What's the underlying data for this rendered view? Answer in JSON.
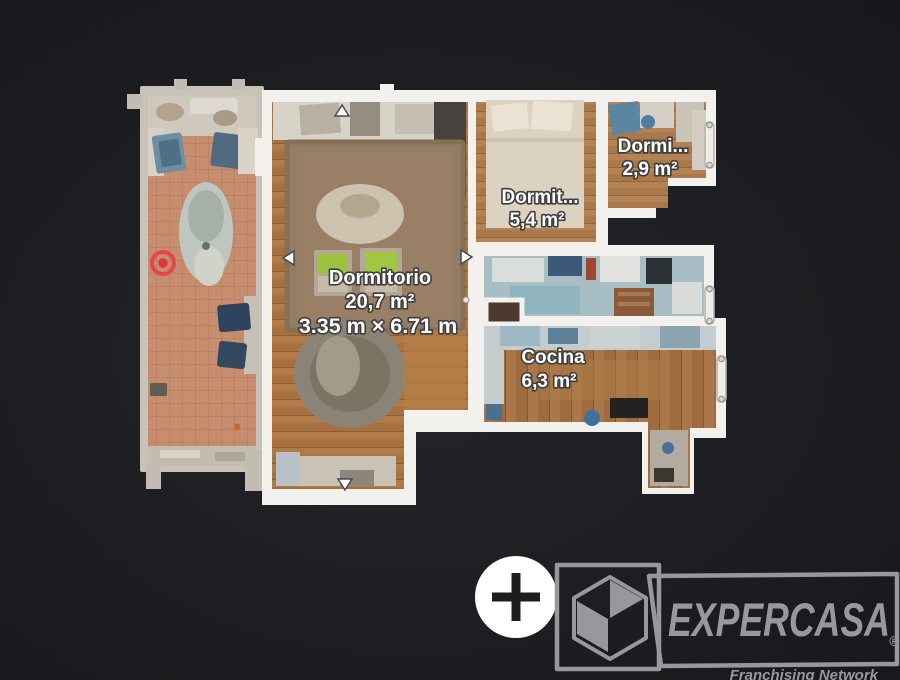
{
  "app": {
    "type": "floor-plan-viewer"
  },
  "background": {
    "color": "#1d1e21"
  },
  "floor_plan": {
    "wall_color": "#f3f1ee",
    "marker_color": "#e84352",
    "rooms": [
      {
        "id": "terrace"
      },
      {
        "id": "dormitorio",
        "name": "Dormitorio",
        "area": "20,7 m²",
        "dimensions": "3.35 m × 6.71 m"
      },
      {
        "id": "dormitorio-2",
        "name": "Dormit...",
        "area": "5,4 m²"
      },
      {
        "id": "dormitorio-3",
        "name": "Dormi...",
        "area": "2,9 m²"
      },
      {
        "id": "cocina",
        "name": "Cocina",
        "area": "6,3 m²"
      }
    ]
  },
  "controls": {
    "zoom_in_icon": "plus-icon"
  },
  "logo": {
    "brand": "EXPERCASA",
    "registered": "®",
    "tagline": "Franchising Network",
    "color": "#98979c"
  }
}
